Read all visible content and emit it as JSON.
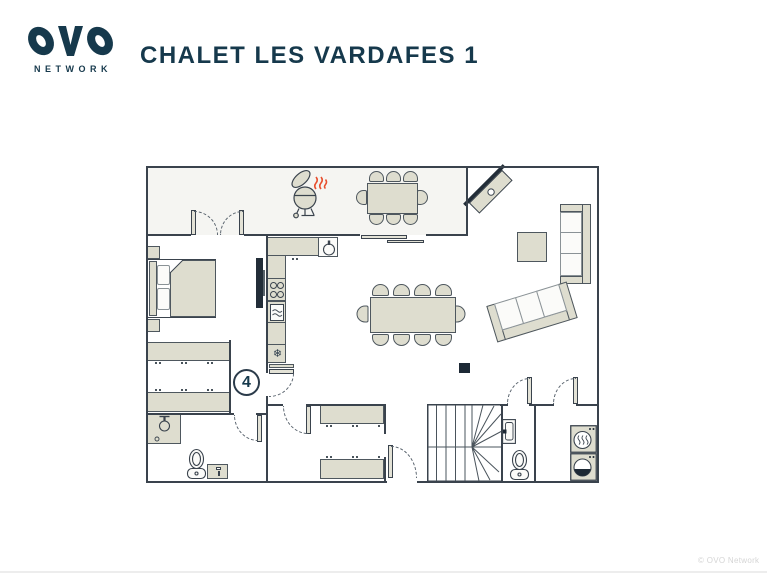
{
  "header": {
    "logo_name": "OVO",
    "logo_network": "NETWORK",
    "title": "CHALET LES VARDAFES 1"
  },
  "plan": {
    "floor_label": "4",
    "snowflake_glyph": "❄",
    "rooms": [
      "terrace",
      "kitchen",
      "dining-area",
      "living-area",
      "bedroom",
      "dressing",
      "bathroom",
      "boot-room",
      "entrance-hall",
      "staircase",
      "wc",
      "laundry"
    ],
    "furniture": [
      "bbq-grill",
      "outdoor-dining-table",
      "outdoor-chairs-8",
      "fireplace-stove",
      "sofa-straight",
      "sofa-angled",
      "coffee-table",
      "dining-table",
      "dining-chairs-10",
      "double-bed",
      "nightstands",
      "tv",
      "kitchen-counter",
      "sink",
      "hob",
      "oven",
      "freezer",
      "wardrobes",
      "shower",
      "toilet",
      "vanity",
      "boot-shelves",
      "stairs",
      "hand-basin",
      "tumble-dryer",
      "washing-machine"
    ],
    "colors": {
      "wall": "#3a434d",
      "furniture_fill": "#deddcf",
      "accent_navy": "#16394c",
      "terrace_fill": "#f5f5f2",
      "heat_red": "#e8502f",
      "marker_dark": "#1d2935"
    }
  },
  "footer": {
    "copyright": "© OVO Network"
  }
}
